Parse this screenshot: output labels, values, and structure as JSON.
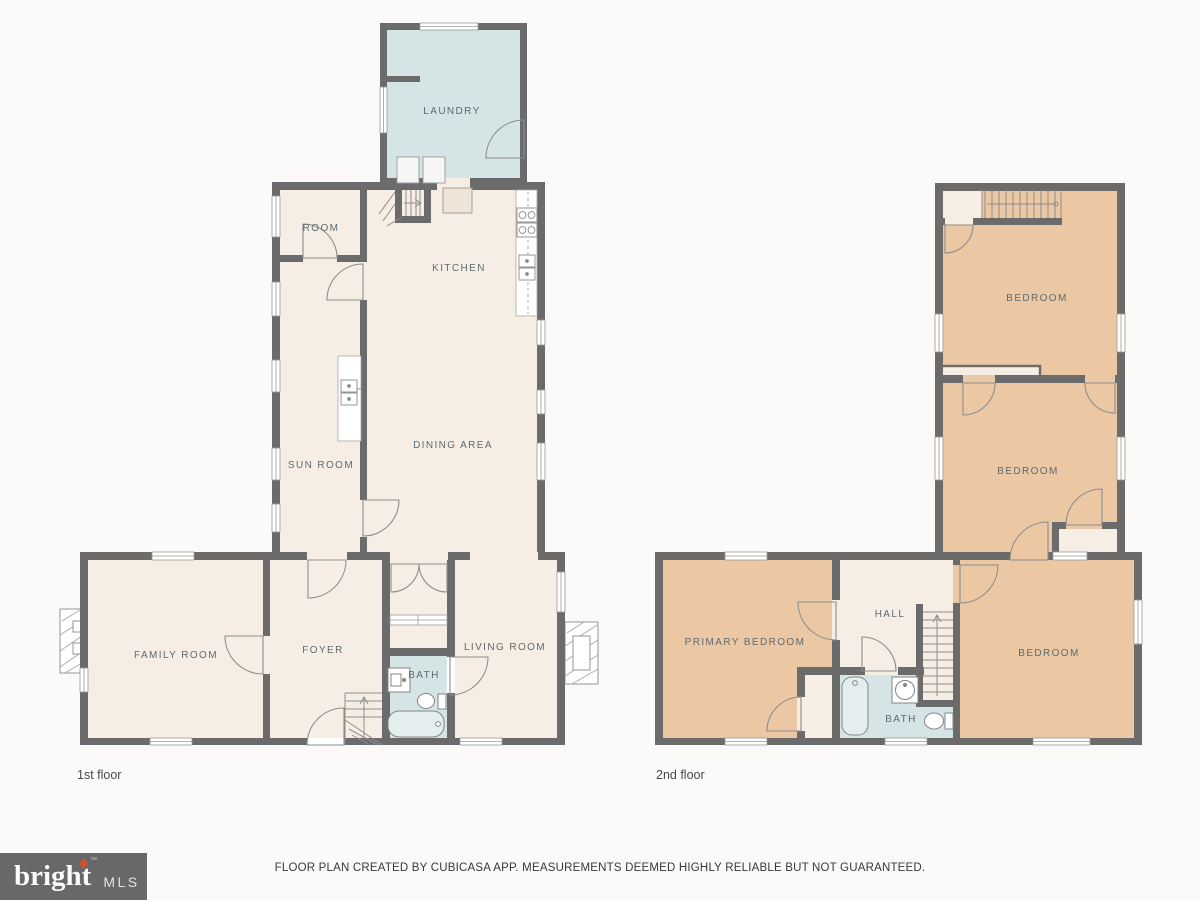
{
  "floor1": {
    "caption": "1st floor",
    "rooms": {
      "laundry": "LAUNDRY",
      "room": "ROOM",
      "kitchen": "KITCHEN",
      "sun_room": "SUN ROOM",
      "dining_area": "DINING AREA",
      "family_room": "FAMILY ROOM",
      "foyer": "FOYER",
      "bath": "BATH",
      "living_room": "LIVING ROOM"
    }
  },
  "floor2": {
    "caption": "2nd floor",
    "rooms": {
      "bedroom_top": "BEDROOM",
      "bedroom_middle": "BEDROOM",
      "primary_bedroom": "PRIMARY BEDROOM",
      "hall": "HALL",
      "bath": "BATH",
      "bedroom_right": "BEDROOM"
    }
  },
  "footer": {
    "logo_text": "bright",
    "logo_suffix": "MLS",
    "disclaimer": "FLOOR PLAN CREATED BY CUBICASA APP. MEASUREMENTS DEEMED HIGHLY RELIABLE BUT NOT GUARANTEED."
  },
  "colors": {
    "wall": "#6b6b6b",
    "room_default": "#f6eee4",
    "room_wet": "#d5e4e5",
    "room_bedroom": "#ebc8a3",
    "label_text": "#5d6a73",
    "background": "#fbfaf8",
    "logo_background": "#686868",
    "logo_plus": "#cf5330"
  }
}
